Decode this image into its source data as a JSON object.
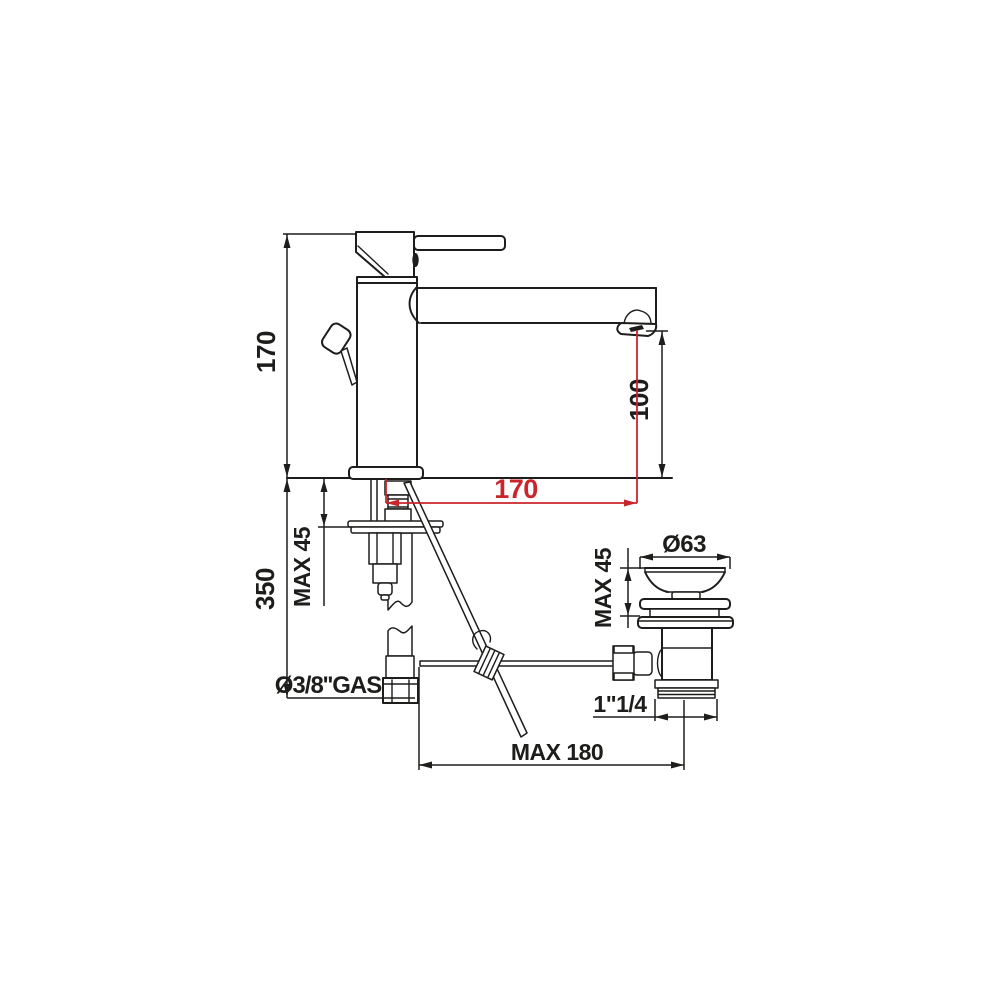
{
  "page": {
    "background": "#ffffff"
  },
  "drawing": {
    "type": "technical-dimension-drawing",
    "subject": "single-lever basin mixer tap with pop-up waste",
    "line_color": "#1d1d1b",
    "accent_color": "#c9252b",
    "dimensions": {
      "total_height": "170",
      "spout_outlet_height": "100",
      "spout_reach": "170",
      "under_counter_depth": "350",
      "counter_thickness_max": "MAX 45",
      "supply_connection": "Ø3/8''GAS",
      "waste_flange_diameter": "Ø63",
      "waste_clamping_max": "MAX 45",
      "waste_thread": "1\"1/4",
      "linkage_reach_max": "MAX 180"
    }
  }
}
